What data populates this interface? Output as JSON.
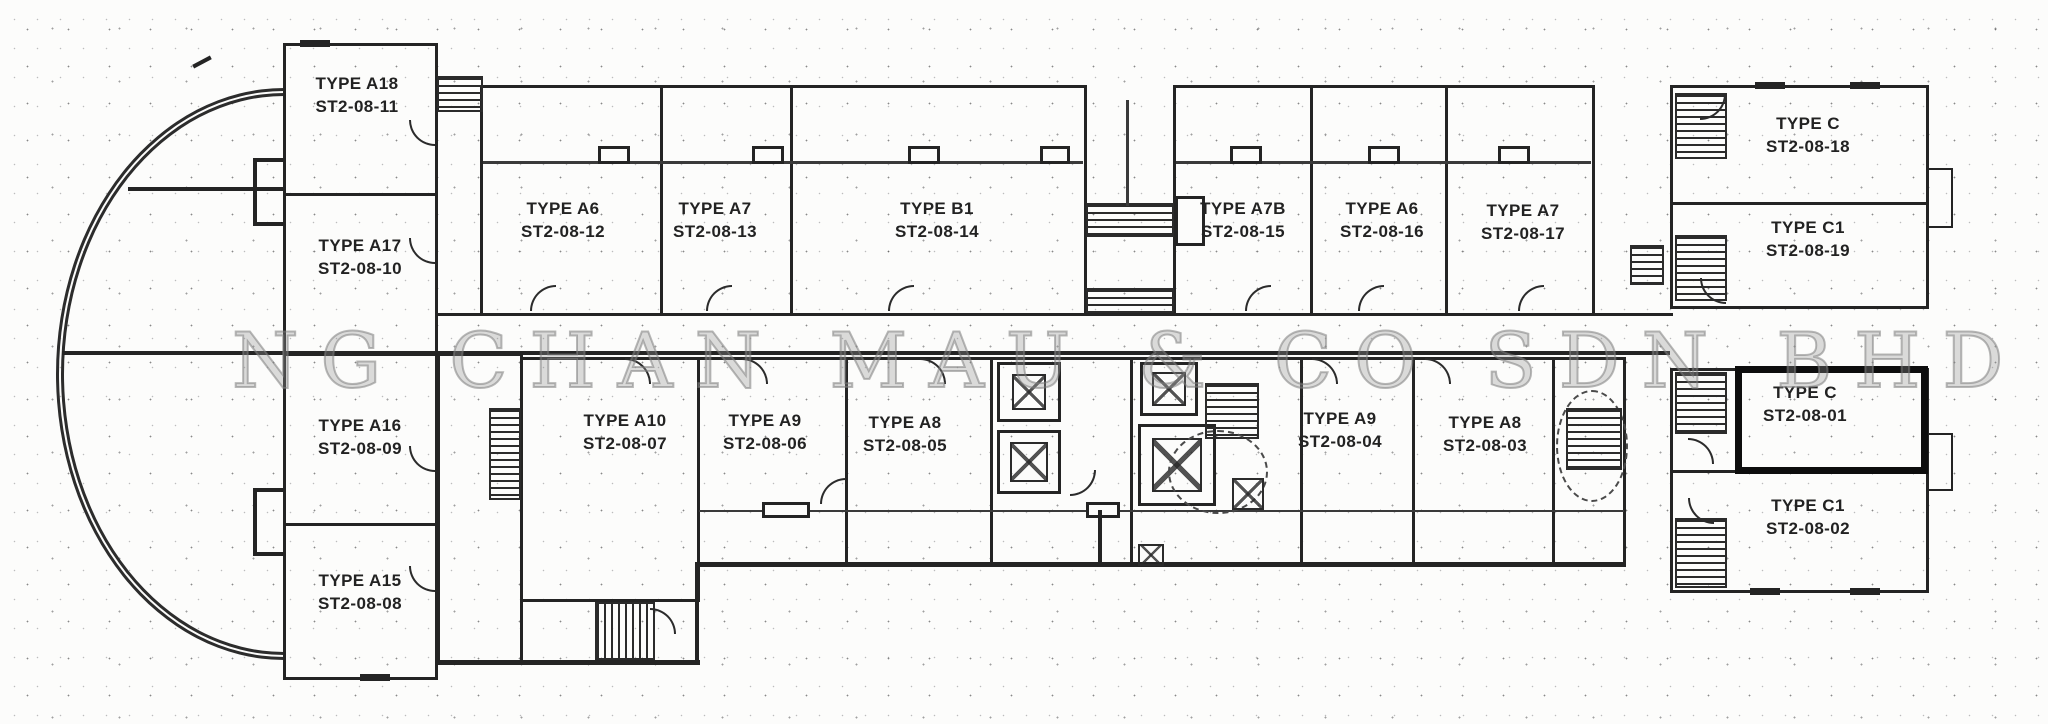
{
  "watermark": {
    "text": "NG CHAN MAU & CO SDN BHD"
  },
  "plan": {
    "ink_color": "#242424",
    "highlight_color": "#0d0d0d",
    "highlighted_unit": "ST2-08-01",
    "units": [
      {
        "type": "TYPE A18",
        "lot": "ST2-08-11"
      },
      {
        "type": "TYPE A17",
        "lot": "ST2-08-10"
      },
      {
        "type": "TYPE A16",
        "lot": "ST2-08-09"
      },
      {
        "type": "TYPE A15",
        "lot": "ST2-08-08"
      },
      {
        "type": "TYPE A6",
        "lot": "ST2-08-12"
      },
      {
        "type": "TYPE A7",
        "lot": "ST2-08-13"
      },
      {
        "type": "TYPE B1",
        "lot": "ST2-08-14"
      },
      {
        "type": "TYPE A7B",
        "lot": "ST2-08-15"
      },
      {
        "type": "TYPE A6",
        "lot": "ST2-08-16"
      },
      {
        "type": "TYPE A7",
        "lot": "ST2-08-17"
      },
      {
        "type": "TYPE C",
        "lot": "ST2-08-18"
      },
      {
        "type": "TYPE C1",
        "lot": "ST2-08-19"
      },
      {
        "type": "TYPE C",
        "lot": "ST2-08-01"
      },
      {
        "type": "TYPE C1",
        "lot": "ST2-08-02"
      },
      {
        "type": "TYPE A10",
        "lot": "ST2-08-07"
      },
      {
        "type": "TYPE A9",
        "lot": "ST2-08-06"
      },
      {
        "type": "TYPE A8",
        "lot": "ST2-08-05"
      },
      {
        "type": "TYPE A9",
        "lot": "ST2-08-04"
      },
      {
        "type": "TYPE A8",
        "lot": "ST2-08-03"
      }
    ]
  }
}
